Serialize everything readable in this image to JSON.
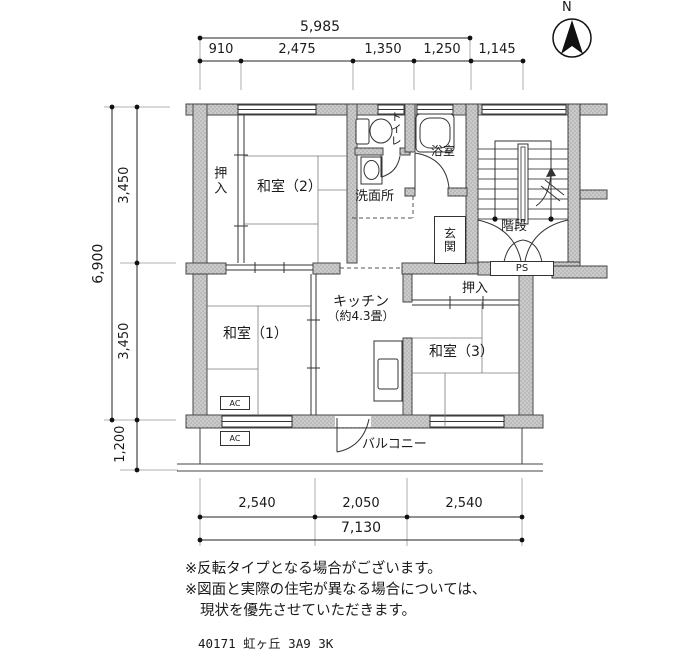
{
  "compass": {
    "label": "N"
  },
  "dimensions": {
    "top": {
      "total": "5,985",
      "seg1": "910",
      "seg2": "2,475",
      "seg3": "1,350",
      "seg4": "1,250",
      "seg5": "1,145"
    },
    "left": {
      "total": "6,900",
      "seg1": "3,450",
      "seg2": "3,450",
      "balcony": "1,200"
    },
    "bottom": {
      "seg1": "2,540",
      "seg2": "2,050",
      "seg3": "2,540",
      "total": "7,130"
    }
  },
  "rooms": {
    "oshiire_upper": "押入",
    "washitsu2": "和室（2）",
    "toilet": "トイレ",
    "bath": "浴室",
    "washroom": "洗面所",
    "genkan": "玄関",
    "stairs": "階段",
    "kitchen_line1": "キッチン",
    "kitchen_line2": "（約4.3畳）",
    "washitsu1": "和室（1）",
    "oshiire_lower": "押入",
    "washitsu3": "和室（3）",
    "balcony": "バルコニー"
  },
  "labels": {
    "ps": "PS",
    "ac": "AC"
  },
  "notes": {
    "line1": "※反転タイプとなる場合がございます。",
    "line2": "※図面と実際の住宅が異なる場合については、",
    "line3": "現状を優先させていただきます。"
  },
  "footer": "40171_虹ヶ丘_3A9_3K"
}
